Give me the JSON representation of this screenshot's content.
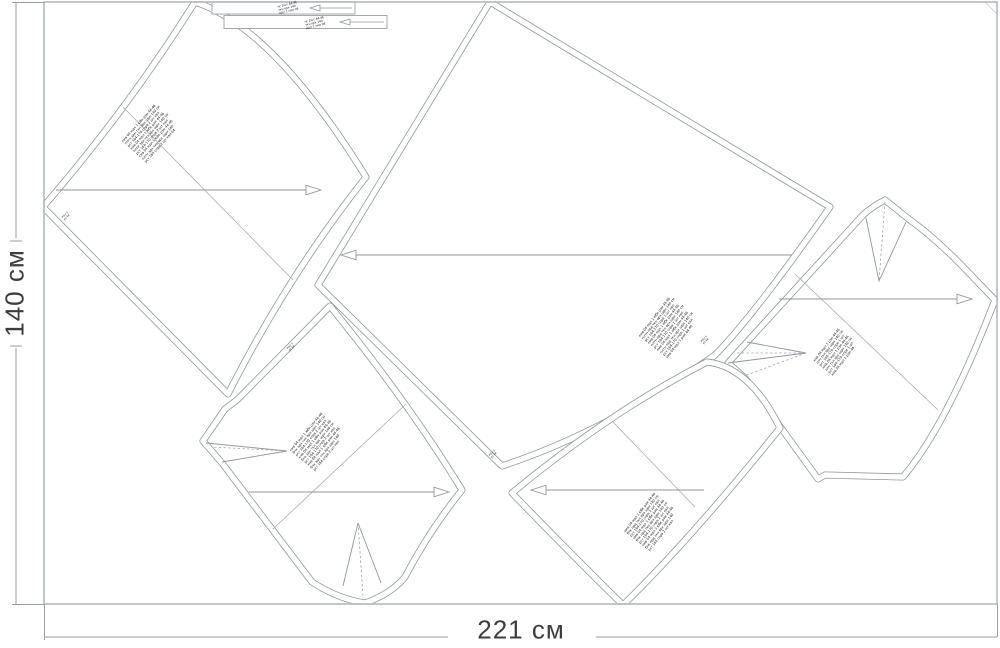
{
  "dimensions": {
    "height_label": "140 см",
    "width_label": "221 см"
  },
  "colors": {
    "line": "#8f979b",
    "fabric_border": "#b4b9bc",
    "dotted": "#a0a6a9",
    "label_text": "#161616",
    "dimension_text": "#3d3d3d"
  },
  "pieces": [
    {
      "name": "back-panel-upper-left",
      "label_lines": [
        "кмв 04 мдл 1 юбк рзм 44-46",
        "плтн здн ткн врх шрн 140 см",
        "рст 164-170 спрв 2 шт квл",
        "кмв 04 мдл 1 юбк рзм 44-46",
        "плтн здн ткн врх шрн 140 см",
        "рст 164-170 спрв 2 шт квл",
        "кмв 04 мдл 1 юбк рзм 44-46",
        "плтн здн ткн врх шрн 140",
        "рст 164 спрв 2 шт квл 04"
      ]
    },
    {
      "name": "front-panel-center",
      "label_lines": [
        "кмв 04 мдл 1 юбк рзм 44-46",
        "плтн прд ткн врх шрн 140 см",
        "рст 164-170 спрв 1 шт квл",
        "кмв 04 мдл 1 юбк рзм 44-46",
        "плтн прд ткн врх шрн 140 см",
        "рст 164-170 спрв 1 шт квл",
        "кмв 04 мдл 1 юбк рзм 44-46",
        "плтн прд ткн врх шрн 140 см",
        "рст 164-170 спрв 1 шт квл",
        "кмв 04 мдл 1 рзм 44-46"
      ]
    },
    {
      "name": "bodice-right",
      "label_lines": [
        "кмв 04 мдл 1 рзм 44-46",
        "плч ткн врх шрн 140 см",
        "рст 164-170 спрв 1 шт",
        "кмв 04 мдл 1 рзм 44-46",
        "плч ткн врх шрн 140 см",
        "рст 164-170 спрв 1 шт",
        "кмв 04 мдл 1 рзм 44"
      ]
    },
    {
      "name": "side-panel-lower-left",
      "label_lines": [
        "кмв 04 мдл 1 юбк рзм 44-46",
        "бчк здн ткн врх шрн 140 см",
        "рст 164-170 спрв 2 шт квл",
        "кмв 04 мдл 1 юбк рзм 44-46",
        "бчк здн ткн врх шрн 140 см",
        "рст 164-170 спрв 2 шт квл",
        "кмв 04 мдл 1 юбк рзм 44-46",
        "бчк здн ткн врх шрн 140",
        "рст 164 спрв 2 шт квл"
      ]
    },
    {
      "name": "side-panel-lower-center",
      "label_lines": [
        "кмв 04 мдл 1 юбк рзм 44-46",
        "бчк прд ткн врх шрн 140 см",
        "рст 164-170 спрв 2 шт квл",
        "кмв 04 мдл 1 юбк рзм 44-46",
        "бчк прд ткн врх шрн 140 см",
        "рст 164-170 спрв 2 шт квл",
        "кмв 04 мдл 1 юбк рзм 44-46",
        "бчк прд ткн врх шрн 140",
        "рст 164 спрв 2 шт квл"
      ]
    }
  ],
  "strips": [
    {
      "name": "waistband-strip-1",
      "label_lines": [
        "пс 2шт 44-46",
        "ткн врх 140",
        "мдл 1 кмв 04"
      ]
    },
    {
      "name": "waistband-strip-2",
      "label_lines": [
        "пс 2шт 44-46",
        "ткн врх 140",
        "мдл 1 кмв 04"
      ]
    }
  ],
  "corner_marks": [
    {
      "lines": [
        "мдл 1",
        "рз 44"
      ]
    },
    {
      "lines": [
        "мдл 1",
        "рз 44"
      ]
    },
    {
      "lines": [
        "мдл 1",
        "рз 44"
      ]
    },
    {
      "lines": [
        "мдл 1",
        "рз 44"
      ]
    }
  ]
}
